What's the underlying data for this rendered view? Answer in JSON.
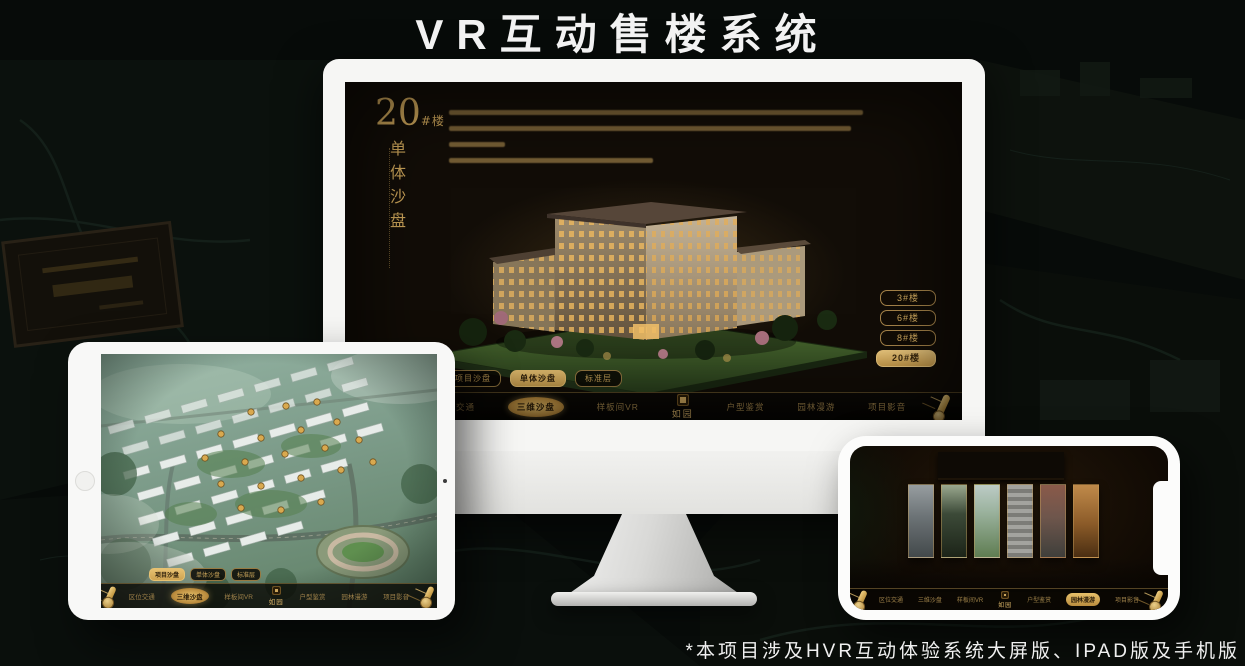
{
  "page": {
    "title": "VR互动售楼系统",
    "footnote": "*本项目涉及HVR互动体验系统大屏版、IPAD版及手机版"
  },
  "colors": {
    "accent_gold": "#C9A25C",
    "accent_gold_bright": "#E6C06A",
    "screen_background": "#120D07",
    "nav_background": "#0B0906",
    "device_white": "#F6F6F4",
    "page_background": "#070B09"
  },
  "monitor": {
    "hero": {
      "number": "20",
      "suffix": "#楼",
      "subtitle": "单体沙盘"
    },
    "floor_buttons": [
      {
        "label": "3#楼",
        "active": false
      },
      {
        "label": "6#楼",
        "active": false
      },
      {
        "label": "8#楼",
        "active": false
      },
      {
        "label": "20#楼",
        "active": true
      }
    ],
    "sub_tabs": [
      {
        "label": "项目沙盘",
        "active": false
      },
      {
        "label": "单体沙盘",
        "active": true
      },
      {
        "label": "标准层",
        "active": false
      }
    ],
    "nav": {
      "logo": "如园",
      "items": [
        {
          "label": "区位交通",
          "active": false
        },
        {
          "label": "三维沙盘",
          "active": true
        },
        {
          "label": "样板间VR",
          "active": false
        },
        {
          "label": "户型鉴赏",
          "active": false
        },
        {
          "label": "园林漫游",
          "active": false
        },
        {
          "label": "项目影音",
          "active": false
        }
      ]
    }
  },
  "tablet": {
    "sub_tabs": [
      {
        "label": "项目沙盘",
        "active": true
      },
      {
        "label": "单体沙盘",
        "active": false
      },
      {
        "label": "标准层",
        "active": false
      }
    ],
    "nav": {
      "logo": "如园",
      "items": [
        {
          "label": "区位交通",
          "active": false
        },
        {
          "label": "三维沙盘",
          "active": true
        },
        {
          "label": "样板间VR",
          "active": false
        },
        {
          "label": "户型鉴赏",
          "active": false
        },
        {
          "label": "园林漫游",
          "active": false
        },
        {
          "label": "项目影音",
          "active": false
        }
      ]
    }
  },
  "phone": {
    "nav": {
      "logo": "如园",
      "items": [
        {
          "label": "区位交通",
          "active": false
        },
        {
          "label": "三维沙盘",
          "active": false
        },
        {
          "label": "样板间VR",
          "active": false
        },
        {
          "label": "户型鉴赏",
          "active": false
        },
        {
          "label": "园林漫游",
          "active": true
        },
        {
          "label": "项目影音",
          "active": false
        }
      ]
    }
  }
}
